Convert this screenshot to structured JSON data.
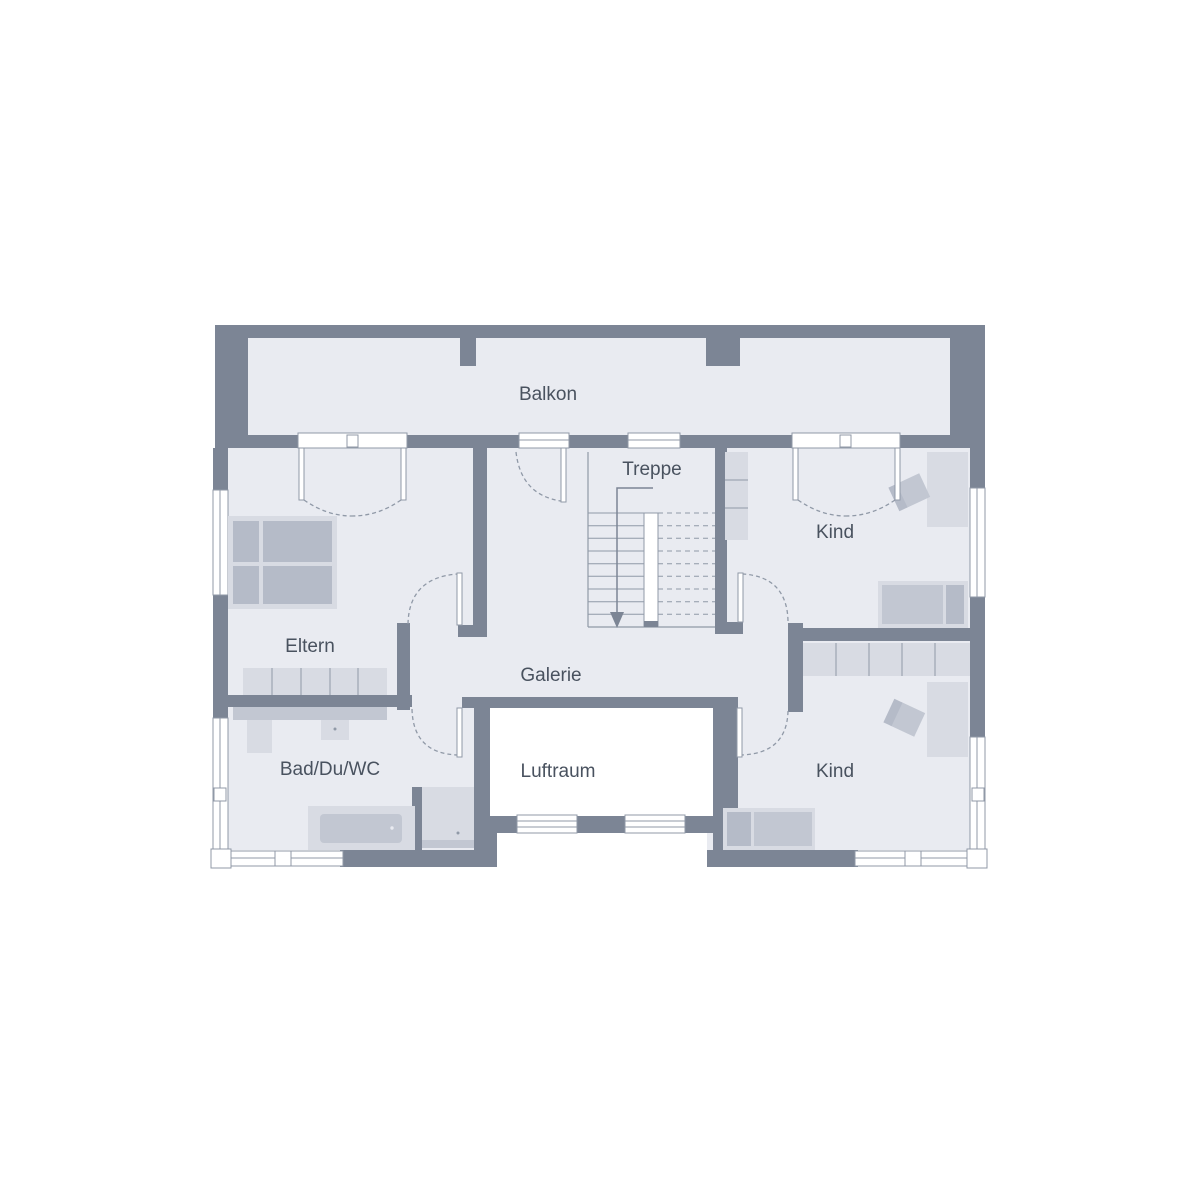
{
  "plan": {
    "type": "floor-plan",
    "rooms": {
      "balkon": "Balkon",
      "treppe": "Treppe",
      "kind_top": "Kind",
      "eltern": "Eltern",
      "galerie": "Galerie",
      "bad": "Bad/Du/WC",
      "luftraum": "Luftraum",
      "kind_bottom": "Kind"
    },
    "colors": {
      "wall": "#7c8595",
      "floor": "#e9ebf1",
      "furniture_light": "#d8dbe3",
      "furniture_mid": "#c2c7d2",
      "furniture_dark": "#b5bbc8",
      "line": "#9099a7",
      "label": "#49525f",
      "background": "#ffffff"
    }
  }
}
